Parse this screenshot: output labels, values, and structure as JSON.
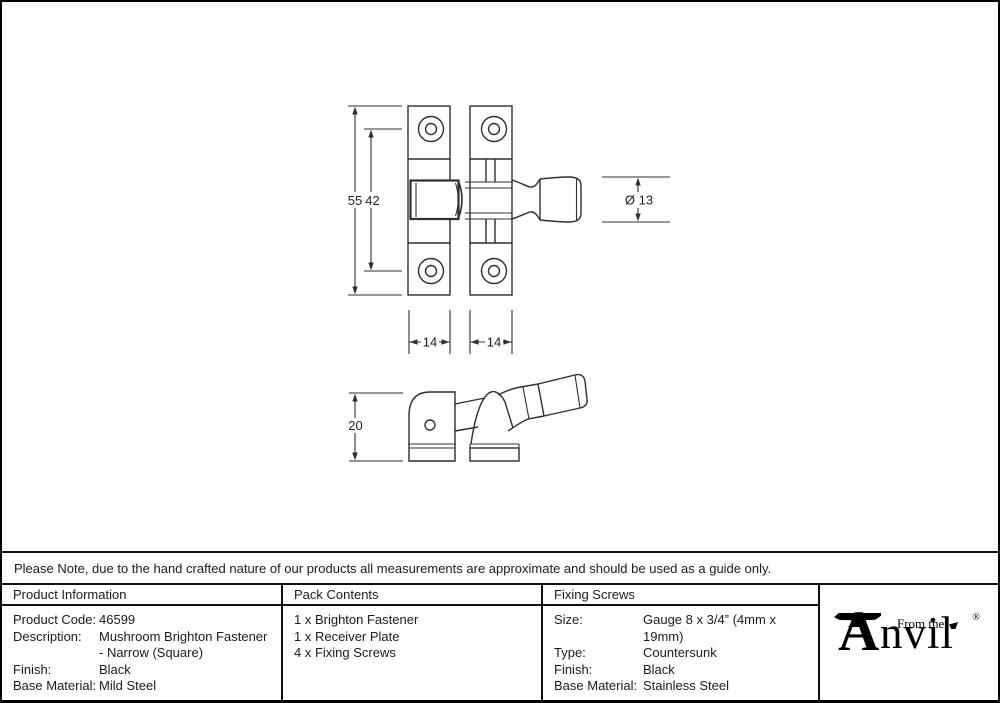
{
  "note": {
    "text": "Please Note, due to the hand crafted nature of our products all measurements are approximate and should be used as a guide only."
  },
  "drawing": {
    "front_view": {
      "overall_height": "55",
      "hole_spacing": "42",
      "knob_diameter": "Ø 13",
      "keep_plate_width": "14",
      "receiver_plate_width": "14"
    },
    "side_view": {
      "depth": "20"
    }
  },
  "table": {
    "product_info": {
      "header": "Product Information",
      "rows": [
        {
          "label": "Product Code:",
          "value": "46599"
        },
        {
          "label": "Description:",
          "value": "Mushroom Brighton Fastener"
        },
        {
          "label": "",
          "value": "- Narrow (Square)"
        },
        {
          "label": "Finish:",
          "value": "Black"
        },
        {
          "label": "Base Material:",
          "value": "Mild Steel"
        }
      ]
    },
    "pack_contents": {
      "header": "Pack Contents",
      "items": [
        "1 x Brighton Fastener",
        "1 x Receiver Plate",
        "4 x Fixing Screws"
      ]
    },
    "fixing_screws": {
      "header": "Fixing Screws",
      "rows": [
        {
          "label": "Size:",
          "value": "Gauge 8 x 3/4” (4mm x 19mm)"
        },
        {
          "label": "Type:",
          "value": "Countersunk"
        },
        {
          "label": "Finish:",
          "value": "Black"
        },
        {
          "label": "Base Material:",
          "value": "Stainless Steel"
        }
      ]
    }
  },
  "logo": {
    "from_the": "From the",
    "letter_a": "A",
    "nvil": "nvil",
    "registered": "®"
  },
  "colors": {
    "line": "#2f2f2f",
    "text": "#1b1b1b",
    "border": "#000000",
    "background": "#ffffff"
  }
}
